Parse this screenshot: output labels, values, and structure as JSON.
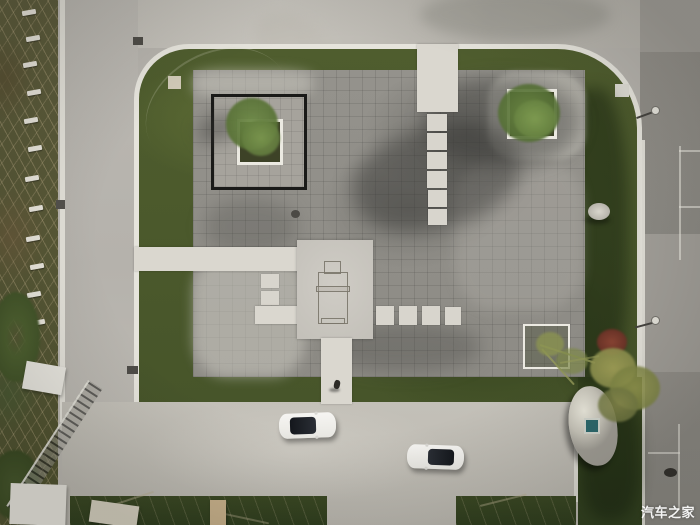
{
  "meta": {
    "type": "aerial-drone-photograph",
    "subject": "Top-down drone view of a landscaped memorial plaza with dark stone paving, white stepping-stone walkways, square tree planters, surrounding lawns and roads, roadside staked saplings and two white cars"
  },
  "watermark": {
    "text": "汽车之家",
    "color": "#ffffff"
  },
  "palette": {
    "concrete_road": "#b9b6b0",
    "bottom_road_light": "#c4c1b9",
    "dark_asphalt_parking": "#918e88",
    "lawn_green": "#4e5b2d",
    "dark_lawn": "#35441f",
    "plaza_pavers_gray": "#93918b",
    "walkway_white": "#dad7cf",
    "curb_white": "#e6e4dc",
    "planter_border_black": "#1a1a18",
    "tree_green": "#5f7d3d",
    "autumn_tree_yellow": "#94984e",
    "shrub_red": "#8a4433",
    "boulder_white": "#edebdf",
    "car_white": "#f2f1ee",
    "car_glass_dark": "#1e2126",
    "plaque_teal": "#2c6a6e"
  },
  "scene": {
    "elements": [
      "plaza-paving",
      "central-monument-pad",
      "monument-outline",
      "stepping-stone-column",
      "left-entry-walkway",
      "bottom-exit-walkway",
      "black-framed-planter",
      "tree-planter-top-right",
      "tree-planter-bottom-right",
      "perimeter-lawn",
      "white-curb",
      "roadside-saplings",
      "street-lamp",
      "boulder",
      "rock",
      "red-shrub",
      "autumn-tree",
      "white-car-upper",
      "white-car-lower",
      "pedestrian",
      "parking-lines",
      "guardrail",
      "info-plaque"
    ]
  }
}
